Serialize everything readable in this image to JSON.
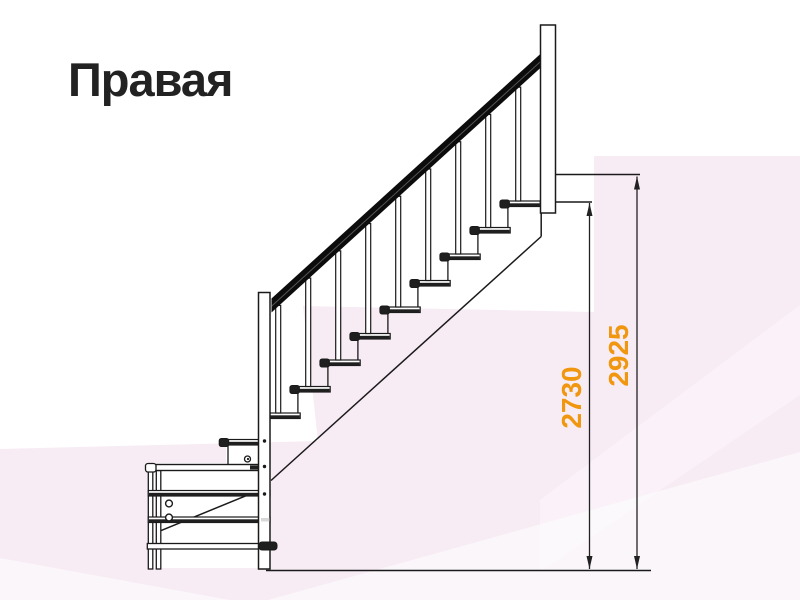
{
  "title": {
    "text": "Правая"
  },
  "colors": {
    "paper": "#ffffff",
    "pink_main": "#f7ecf4",
    "light_overlay": "rgba(255,255,255,0.5)",
    "light_overlay_soft": "rgba(255,255,255,0.35)",
    "line": "#1a1a1a",
    "rail_black": "#0c0c0c",
    "rail_sheen": "#555555",
    "tread_dark": "#1f1f1f",
    "accent_orange": "#f0960f",
    "dim_line": "#222222",
    "patch_gray": "#d8d8d8"
  },
  "background_shapes": [
    {
      "name": "pink-main-area",
      "points": "0,449 318,441 303,306 594,312 594,156 800,156 800,600 0,600",
      "fill_key": "pink_main"
    },
    {
      "name": "light-band-bottom-right",
      "points": "268,600 800,452 800,600",
      "fill_key": "light_overlay"
    },
    {
      "name": "light-corner-bottom-left",
      "points": "0,558 230,600 0,600",
      "fill_key": "light_overlay"
    },
    {
      "name": "light-streak-right",
      "points": "540,500 800,305 800,395 540,572",
      "fill_key": "light_overlay_soft"
    }
  ],
  "dimensions": [
    {
      "label": "2730",
      "x": 589.5,
      "y_top": 203,
      "y_bottom": 569,
      "label_x": 571.5,
      "label_y": 397.5,
      "font_size": 28
    },
    {
      "label": "2925",
      "x": 637,
      "y_top": 176.5,
      "y_bottom": 569,
      "label_x": 618.5,
      "label_y": 355.5,
      "font_size": 28
    }
  ],
  "staircase": {
    "ground": {
      "y": 570.5,
      "x1": 266,
      "x2": 651
    },
    "landing_line": {
      "y": 174.5,
      "x1": 555,
      "x2": 640
    },
    "ext_line": {
      "y": 202,
      "x1": 555,
      "x2": 592
    },
    "white_fills": [
      {
        "x": 149,
        "y": 463,
        "w": 122,
        "h": 105
      },
      {
        "x": 226,
        "y": 443,
        "w": 36,
        "h": 23
      }
    ],
    "newel_top": {
      "x": 540.5,
      "w": 15,
      "top": 25,
      "bottom": 213
    },
    "newel_bottom": {
      "x": 258.5,
      "w": 11.5,
      "top": 292.5,
      "bottom": 569,
      "dot_x": 264.5,
      "dots": [
        441,
        466.5,
        494
      ]
    },
    "stringer": {
      "vx": 541.2,
      "vy1": 213,
      "vy2": 236.5,
      "x2": 271,
      "y2": 480.5
    },
    "handrail": {
      "x1": 271.5,
      "y1_top": 298.5,
      "x2": 542,
      "y2_top": 52.5,
      "th": 14
    },
    "steps": {
      "count": 9,
      "nose_x0": 261.7,
      "top_y0": 413,
      "run": 30,
      "rise": 26.5,
      "len": 38.5,
      "th": 5.5,
      "riser_dx": 6.2,
      "baluster_dx": 16.5,
      "baluster_w": 5
    },
    "first_step": {
      "nose_x": 221,
      "top_y": 439.5,
      "len": 39,
      "th": 5.5,
      "riser_x": 228,
      "riser_y2": 465
    },
    "platform": {
      "top_bar": {
        "x": 147,
        "y": 464.5,
        "len": 113,
        "th": 6
      },
      "top_bar_dark_seg": {
        "x": 250,
        "y": 465.5,
        "w": 8,
        "h": 4
      },
      "legs": [
        {
          "x": 148.3
        },
        {
          "x": 156.3
        }
      ],
      "leg_w": 4.5,
      "leg_top": 470.5,
      "leg_bottom": 569,
      "rails": [
        {
          "y": 490.5
        },
        {
          "y": 517
        }
      ],
      "rail_h": 5.5,
      "rail_x1": 148.3,
      "rail_x2": 270,
      "bottom_rail": {
        "y": 543.5,
        "h": 5.5,
        "x1": 147.3,
        "x2": 262
      },
      "bottom_cap": {
        "x": 259,
        "y": 542,
        "w": 18,
        "h": 8
      },
      "brace": {
        "x1": 158.3,
        "y1": 531.7,
        "x2": 260,
        "y2": 490
      },
      "holes": [
        {
          "cx": 169,
          "cy": 503.5,
          "r": 3.4
        },
        {
          "cx": 169,
          "cy": 517.5,
          "r": 3.4
        }
      ],
      "screw": {
        "cx": 247.5,
        "cy": 459,
        "r": 3
      },
      "light_patch": {
        "x": 261,
        "y": 518,
        "w": 8.5,
        "h": 3.5
      }
    }
  }
}
